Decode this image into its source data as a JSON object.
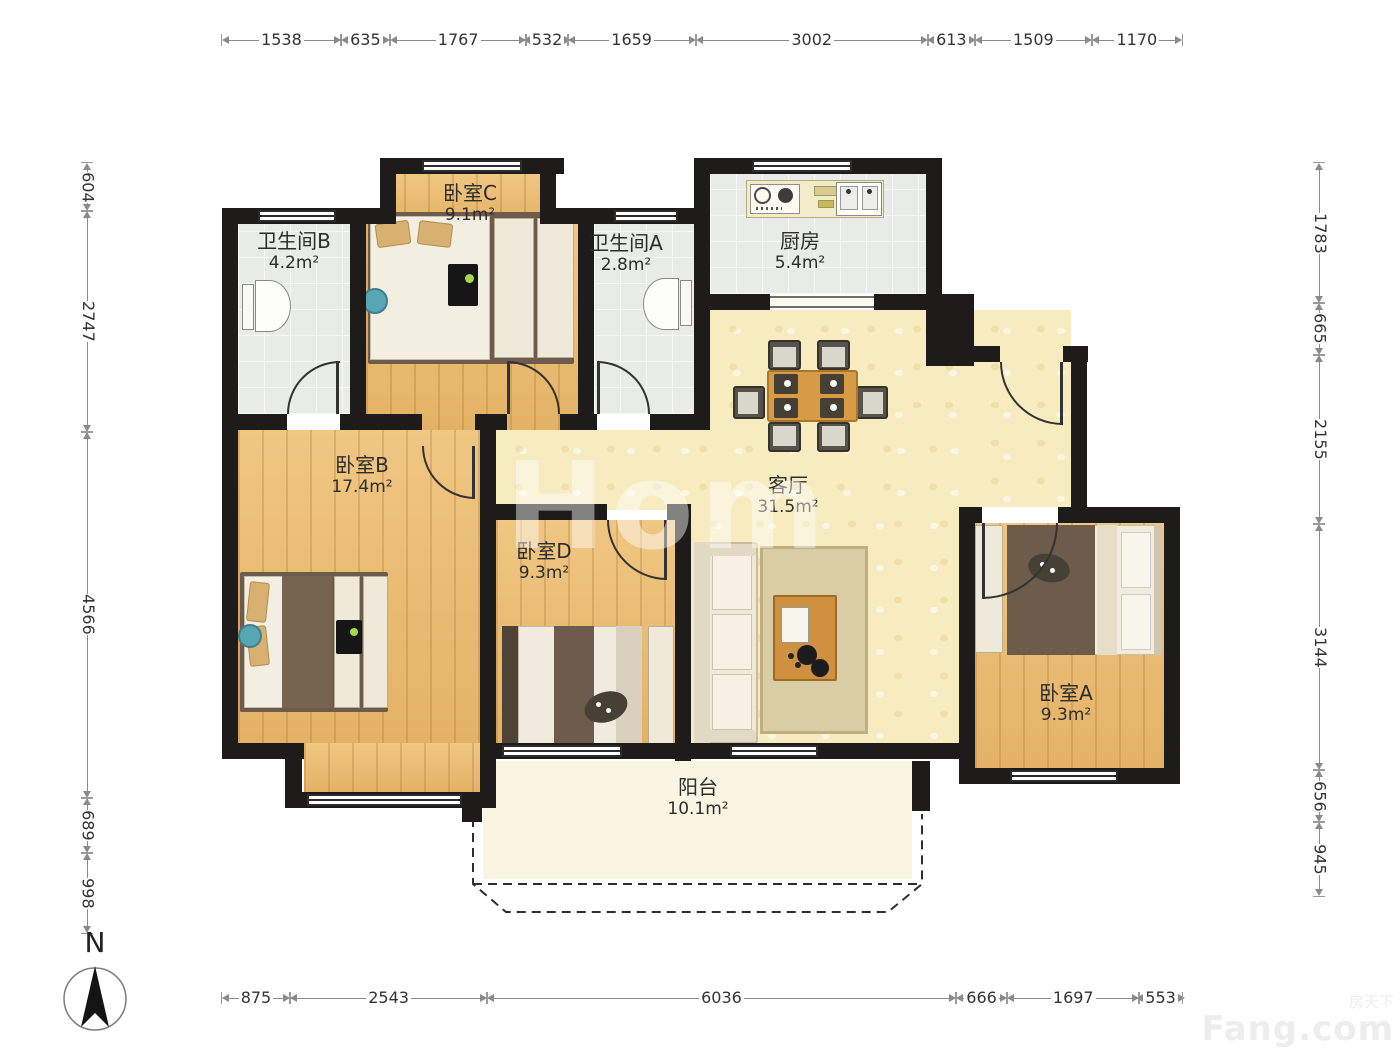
{
  "meta": {
    "north_label": "N",
    "center_watermark": "Hom",
    "watermark_small": "房天下",
    "watermark_brand": "Fang.com"
  },
  "rooms": {
    "bathroom_b": {
      "name": "卫生间B",
      "area": "4.2m²"
    },
    "bedroom_c": {
      "name": "卧室C",
      "area": "9.1m²"
    },
    "bathroom_a": {
      "name": "卫生间A",
      "area": "2.8m²"
    },
    "kitchen": {
      "name": "厨房",
      "area": "5.4m²"
    },
    "bedroom_b": {
      "name": "卧室B",
      "area": "17.4m²"
    },
    "living_room": {
      "name": "客厅",
      "area": "31.5m²"
    },
    "bedroom_d": {
      "name": "卧室D",
      "area": "9.3m²"
    },
    "bedroom_a": {
      "name": "卧室A",
      "area": "9.3m²"
    },
    "balcony": {
      "name": "阳台",
      "area": "10.1m²"
    }
  },
  "dimensions": {
    "top": [
      "1538",
      "635",
      "1767",
      "532",
      "1659",
      "3002",
      "613",
      "1509",
      "1170"
    ],
    "bottom": [
      "875",
      "2543",
      "6036",
      "666",
      "1697",
      "553"
    ],
    "left": [
      "604",
      "2747",
      "4566",
      "689",
      "998"
    ],
    "right": [
      "1783",
      "665",
      "2155",
      "3144",
      "656",
      "945"
    ]
  }
}
